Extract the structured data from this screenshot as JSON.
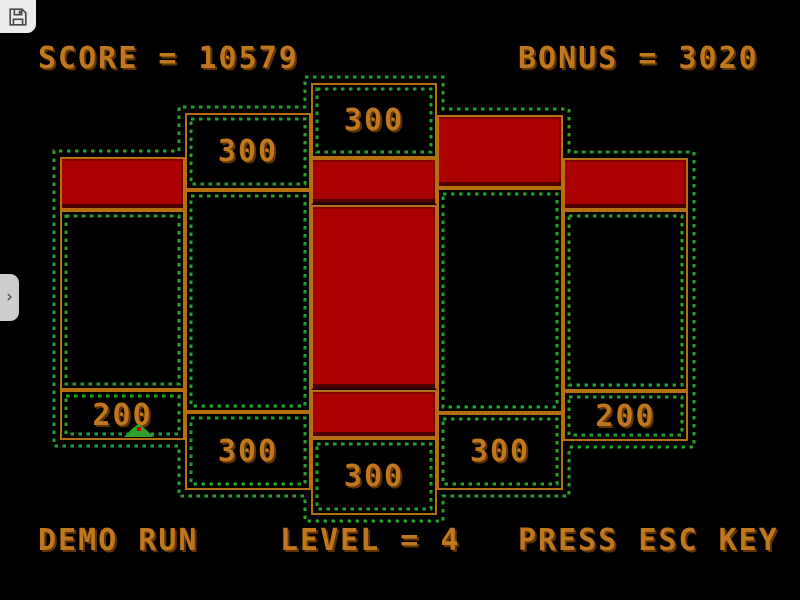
{
  "hud": {
    "score_text": "SCORE = 10579",
    "bonus_text": "BONUS = 3020",
    "demo_text": "DEMO RUN",
    "level_text": "LEVEL = 4",
    "press_text": "PRESS ESC KEY"
  },
  "chrome": {
    "save_icon": "floppy-disk",
    "sidebar_toggle_icon": "chevron-right",
    "sidebar_toggle_glyph": "›"
  },
  "colors": {
    "bg": "#000000",
    "accent_orange": "#c1771c",
    "border_orange": "#b56f10",
    "red_fill": "#ab0000",
    "dot_green": "#26a32e",
    "worm_green": "#2da02d",
    "panel_gray": "#ececec",
    "tab_gray": "#cdcdcd",
    "icon_gray": "#4a4a4a",
    "text_shadow": "#5f3305"
  },
  "board": {
    "boxes": [
      {
        "id": "a1",
        "x": 60,
        "y": 157,
        "w": 125,
        "h": 53,
        "type": "red"
      },
      {
        "id": "a2",
        "x": 60,
        "y": 210,
        "w": 125,
        "h": 180,
        "type": "empty"
      },
      {
        "id": "a3",
        "x": 60,
        "y": 390,
        "w": 125,
        "h": 50,
        "type": "value",
        "label": "200"
      },
      {
        "id": "b1",
        "x": 185,
        "y": 113,
        "w": 126,
        "h": 77,
        "type": "value",
        "label": "300"
      },
      {
        "id": "b2",
        "x": 185,
        "y": 190,
        "w": 126,
        "h": 222,
        "type": "empty"
      },
      {
        "id": "b3",
        "x": 185,
        "y": 412,
        "w": 126,
        "h": 78,
        "type": "value",
        "label": "300"
      },
      {
        "id": "c1",
        "x": 311,
        "y": 83,
        "w": 126,
        "h": 75,
        "type": "value",
        "label": "300"
      },
      {
        "id": "c2",
        "x": 311,
        "y": 158,
        "w": 126,
        "h": 47,
        "type": "red",
        "flat_bottom": true
      },
      {
        "id": "c3",
        "x": 311,
        "y": 205,
        "w": 126,
        "h": 185,
        "type": "red",
        "flat_bottom": true
      },
      {
        "id": "c4",
        "x": 311,
        "y": 390,
        "w": 126,
        "h": 48,
        "type": "red"
      },
      {
        "id": "c5",
        "x": 311,
        "y": 438,
        "w": 126,
        "h": 77,
        "type": "value",
        "label": "300"
      },
      {
        "id": "d1",
        "x": 437,
        "y": 115,
        "w": 126,
        "h": 73,
        "type": "red"
      },
      {
        "id": "d2",
        "x": 437,
        "y": 188,
        "w": 126,
        "h": 225,
        "type": "empty"
      },
      {
        "id": "d3",
        "x": 437,
        "y": 413,
        "w": 126,
        "h": 77,
        "type": "value",
        "label": "300"
      },
      {
        "id": "e1",
        "x": 563,
        "y": 158,
        "w": 125,
        "h": 52,
        "type": "red"
      },
      {
        "id": "e2",
        "x": 563,
        "y": 210,
        "w": 125,
        "h": 181,
        "type": "empty"
      },
      {
        "id": "e3",
        "x": 563,
        "y": 391,
        "w": 125,
        "h": 50,
        "type": "value",
        "label": "200"
      }
    ],
    "perimeter_points": "305,77 443,77 443,109 569,109 569,152 694,152 694,447 569,447 569,496 443,496 443,521 305,521 305,496 179,496 179,446 54,446 54,151 179,151 179,107 305,107",
    "track_inset": 6,
    "player": {
      "x": 124,
      "y": 424
    }
  }
}
